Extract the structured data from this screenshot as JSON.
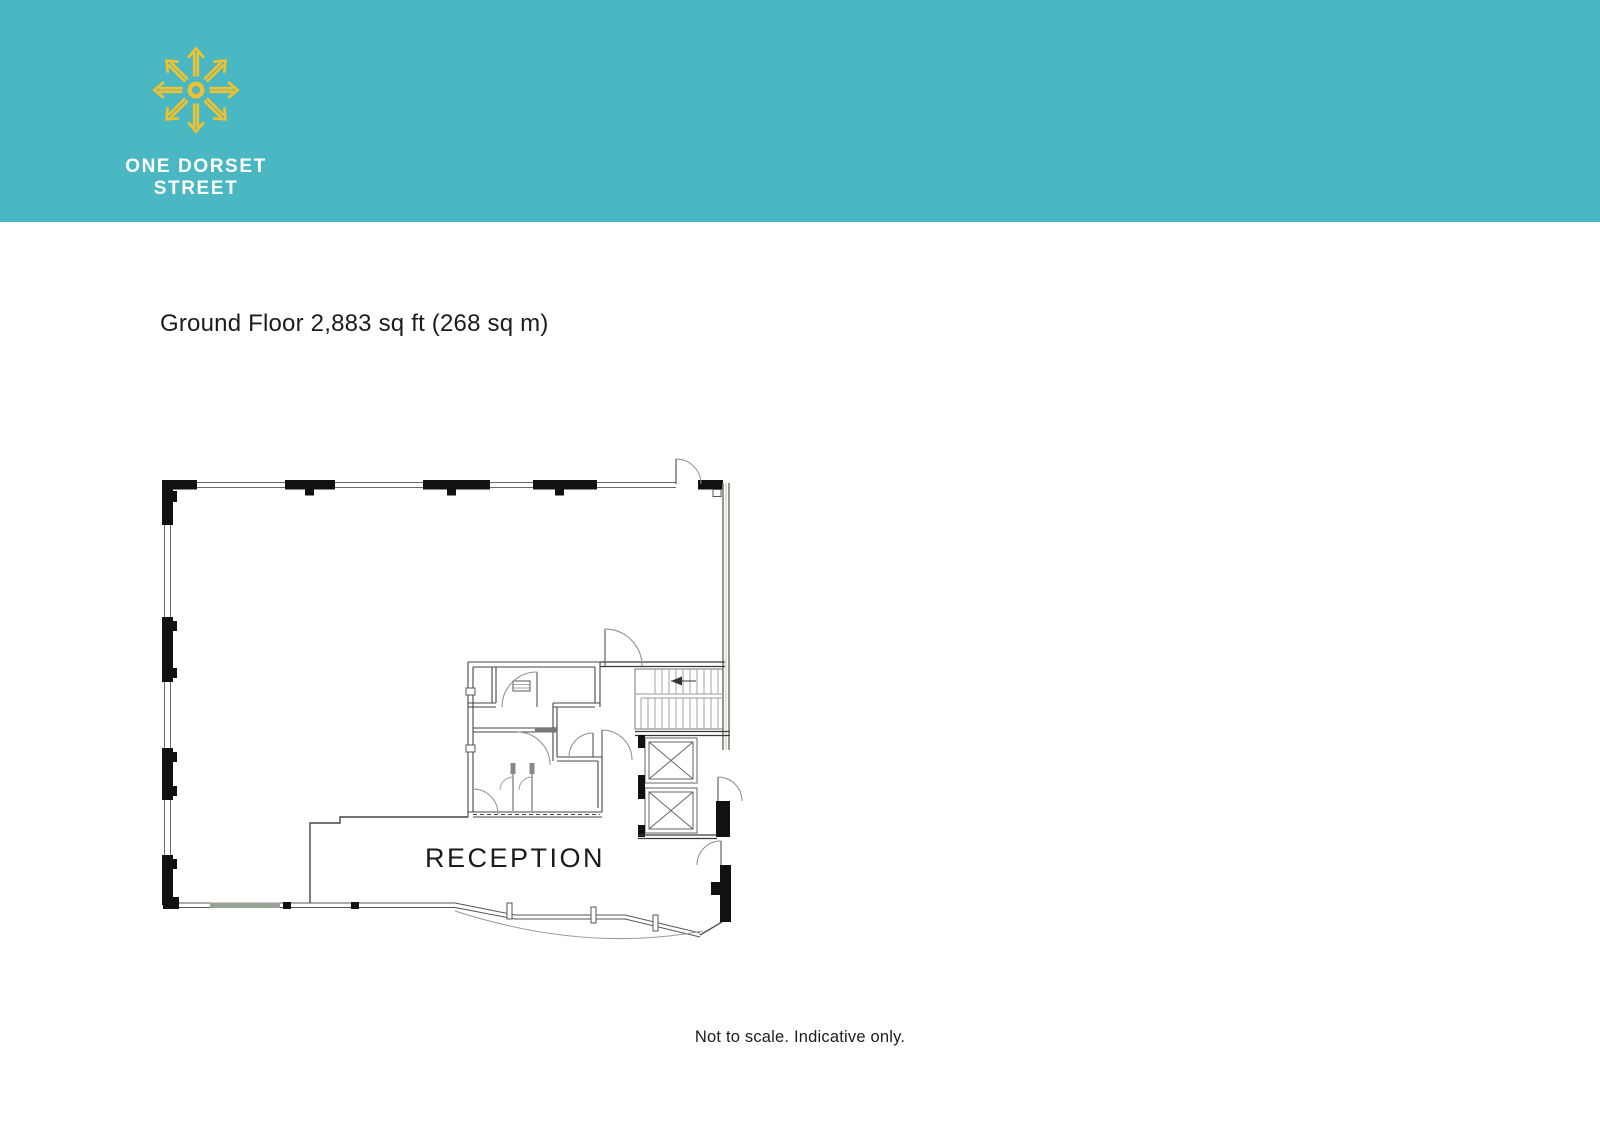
{
  "header": {
    "background_color": "#4ab8c3",
    "logo": {
      "icon": "compass-starburst-icon",
      "color": "#f0c12f"
    },
    "brand_line1": "ONE DORSET",
    "brand_line2": "STREET"
  },
  "main": {
    "title": "Ground Floor 2,883 sq ft (268 sq m)",
    "floor_plan": {
      "room_label": "RECEPTION"
    }
  },
  "footer": {
    "note": "Not to scale. Indicative only."
  }
}
